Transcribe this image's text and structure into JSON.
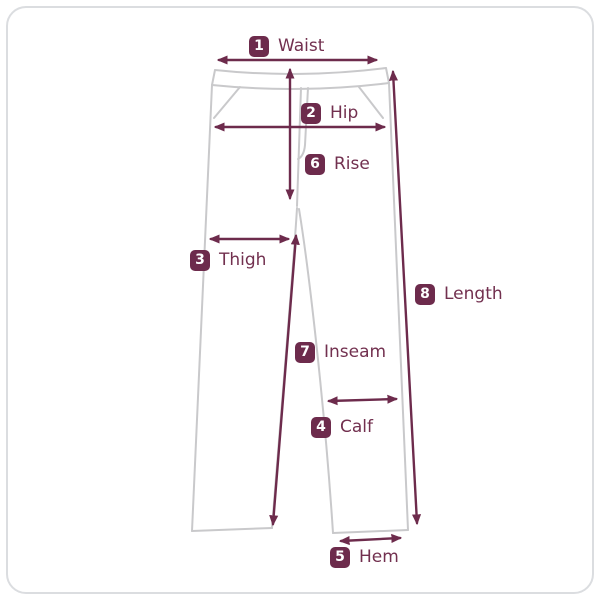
{
  "diagram": {
    "colors": {
      "accent": "#6d2b4c",
      "label_text": "#72304f",
      "badge_text": "#ffffff",
      "outline": "#c9c9cb",
      "card_border": "#dbdde0",
      "background": "#ffffff"
    },
    "measurements": [
      {
        "number": "1",
        "label": "Waist"
      },
      {
        "number": "2",
        "label": "Hip"
      },
      {
        "number": "3",
        "label": "Thigh"
      },
      {
        "number": "4",
        "label": "Calf"
      },
      {
        "number": "5",
        "label": "Hem"
      },
      {
        "number": "6",
        "label": "Rise"
      },
      {
        "number": "7",
        "label": "Inseam"
      },
      {
        "number": "8",
        "label": "Length"
      }
    ]
  }
}
